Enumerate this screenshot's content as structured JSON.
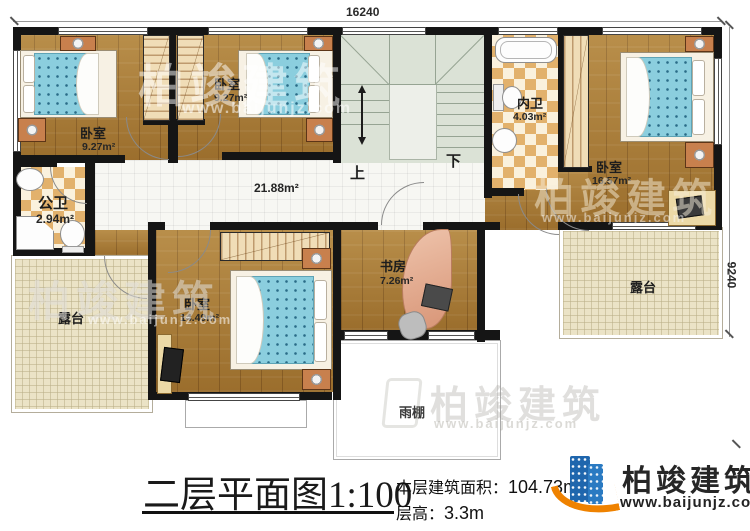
{
  "dimensions": {
    "width_mm": "16240",
    "height_mm": "9240"
  },
  "rooms": {
    "bedroom1": {
      "label": "卧室",
      "area": "9.27m²"
    },
    "bedroom2": {
      "label": "卧室",
      "area": "9.27m²"
    },
    "bedroom3": {
      "label": "卧室",
      "area": "16.57m²"
    },
    "bedroom4": {
      "label": "卧室",
      "area": "14.49m²"
    },
    "study": {
      "label": "书房",
      "area": "7.26m²"
    },
    "public_bath": {
      "label": "公卫",
      "area": "2.94m²"
    },
    "ensuite_bath": {
      "label": "内卫",
      "area": "4.03m²"
    },
    "hallway": {
      "area": "21.88m²"
    },
    "terrace_left": {
      "label": "露台"
    },
    "terrace_right": {
      "label": "露台"
    },
    "canopy": {
      "label": "雨棚"
    }
  },
  "stairs": {
    "up_label": "上",
    "down_label": "下"
  },
  "titleblock": {
    "plan_title": "二层平面图",
    "scale": "1:100",
    "floor_area_label": "本层建筑面积：",
    "floor_area_value": "104.73m²",
    "floor_height_label": "层高：",
    "floor_height_value": "3.3m"
  },
  "brand": {
    "name": "柏竣建筑",
    "website": "www.baijunjz.com"
  },
  "watermark": {
    "name": "柏竣建筑",
    "website": "www.baijunjz.com"
  }
}
